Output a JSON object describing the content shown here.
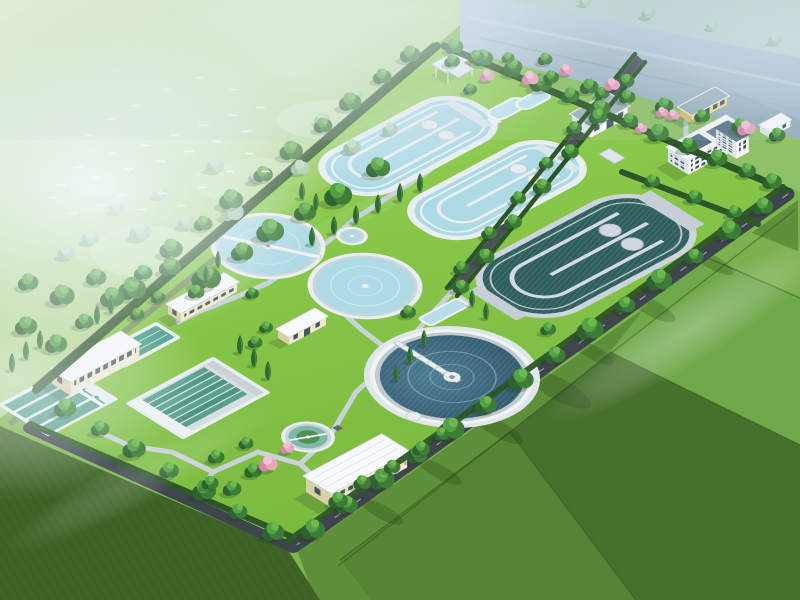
{
  "scene": {
    "title": "Aerial 3D rendering of a wastewater treatment plant",
    "type": "aerial-architectural-rendering",
    "description": "Bird's-eye architectural visualization of a sewage treatment plant with circular clarifiers, serpentine oxidation ditches, lane basins and cream buildings, surrounded by tree belts, farmland, morning haze and a flock of white birds",
    "counts": {
      "circular_tanks": 5,
      "oxidation_ditches": 3,
      "buildings": 10,
      "bird_flock_size": 31
    }
  },
  "features": {
    "site": "Wastewater treatment plant site",
    "oxidation_ditch_a": "Oxidation ditch basin A",
    "oxidation_ditch_b": "Oxidation ditch basin B",
    "oxidation_ditch_dark": "Deep oxidation ditch basin",
    "clarifier_1": "Circular clarifier with scraper bridge",
    "clarifier_2": "Circular clarifier",
    "clarifier_large": "Large secondary clarifier with radial bridge",
    "mini_tank": "Small circular tank",
    "thickener": "Sludge thickener tank",
    "sed_basins": "Rectangular sedimentation basins",
    "filter_basin": "Multi-lane filtration basin",
    "open_pool": "Rectangular holding pool",
    "admin_building": "Two-storey plant building",
    "workshop": "Service workshop building",
    "office_building": "Three-storey office building",
    "gatehouse": "Gatehouse building",
    "small_building_1": "Single-storey plant building",
    "small_building_2": "Small utility building",
    "small_building_3": "Small white utility building",
    "pavilion": "Garden pavilion",
    "landscape_pool": "Decorative curved pool",
    "birds": "Flock of white birds",
    "river_road": "Riverside road",
    "boundary_road": "Perimeter road",
    "internal_road": "Internal tree-lined road",
    "farmland": "Surrounding farmland",
    "meadow": "Wooded meadow",
    "haze": "Atmospheric haze"
  },
  "colors": {
    "lawn": "#86c649",
    "lawn_hi": "#9bd95b",
    "meadow": "#aed28a",
    "meadow_hi": "#dcebc8",
    "field": "#5e8f3a",
    "field_dark": "#47702c",
    "field_mid": "#558434",
    "field_light": "#7cb14f",
    "field_line": "#31511f",
    "field_crop": "#3f6526",
    "water_light": "#aedae6",
    "water_teal": "#57a18c",
    "water_dark": "#2f5f5c",
    "water_clarifier": "#3a637a",
    "wall_white": "#e9eff1",
    "wall_gray": "#c6cfd5",
    "road_dark": "#3f454d",
    "road_internal": "#4a5158",
    "path": "#c9d2d7",
    "river": "#a9bfca",
    "hedge": "#2d5527",
    "tree_dark": "#2e6230",
    "tree_mid": "#3c7c36",
    "tree_light": "#55a044",
    "tree_top": "#6cb851",
    "tree_pale": "#8fb796",
    "tree_pale2": "#a8caa8",
    "cypress": "#2f6a33",
    "pink": "#e8a7bd",
    "pink_dark": "#d488a3",
    "pink_light": "#f2c1d2",
    "cream": "#f0e9cb",
    "cream_shade": "#d9cfa8",
    "white_wall": "#fdfdfd",
    "white_shade": "#dde5e9",
    "roof_white": "#f7f9fa",
    "roof_gray": "#9fb2ba",
    "roof_dark": "#5b7684",
    "yellow_wall": "#ead986",
    "yellow_shade": "#d3be6a",
    "window": "#46565f",
    "bird": "#ffffff",
    "haze": "#eef6fb"
  }
}
